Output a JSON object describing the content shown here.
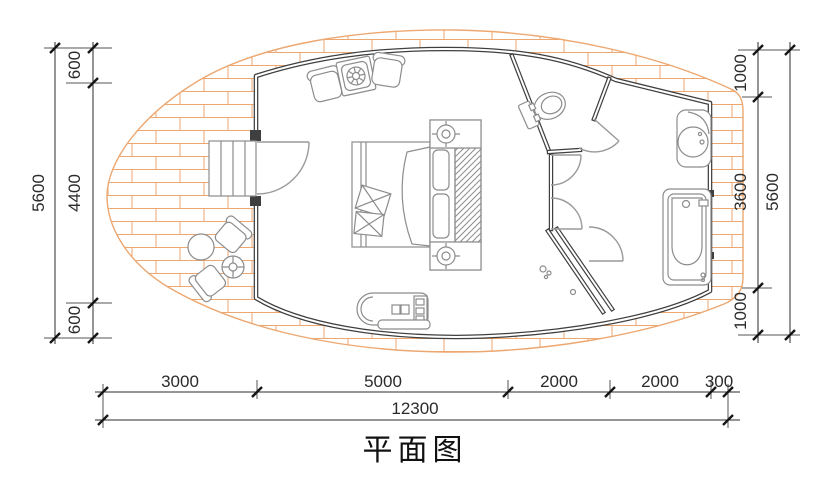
{
  "title": "平面图",
  "dimensions": {
    "left_total": "5600",
    "left_segments": [
      "600",
      "4400",
      "600"
    ],
    "right_total": "5600",
    "right_segments": [
      "1000",
      "3600",
      "1000"
    ],
    "bottom_segments": [
      "3000",
      "5000",
      "2000",
      "2000",
      "300"
    ],
    "bottom_total": "12300"
  },
  "colors": {
    "brick_line": "#eda770",
    "wall": "#3f3f3f",
    "furniture_line": "#8c8c8c",
    "dimension_text": "#2b2b2b",
    "background": "#ffffff"
  },
  "furniture_items": [
    "entry-steps",
    "entry-door",
    "double-bed",
    "decor-pillows",
    "headboard-pillows",
    "nightstand-lamp-top",
    "nightstand-lamp-bottom",
    "wardrobe-hatch",
    "lounge-chair-left",
    "lounge-side-table",
    "lounge-chair-right",
    "media-counter",
    "toilet",
    "toilet-door",
    "vestibule-doors",
    "shower-room",
    "floor-drains",
    "washbasin",
    "bathtub",
    "patio-chairs",
    "patio-round-table",
    "patio-coffee-table"
  ]
}
